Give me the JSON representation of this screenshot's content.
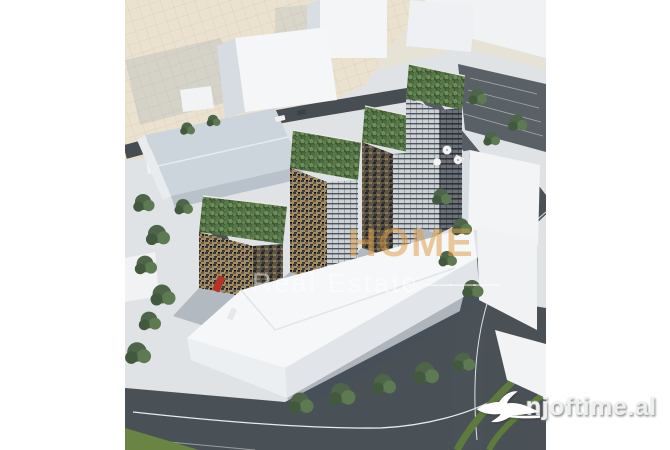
{
  "image": {
    "type": "aerial-architectural-render",
    "subject": "modern residential towers with green rooftops in a city block",
    "palette": {
      "plaza_beige": "#eae2cf",
      "ground_cool": "#e0e4e8",
      "road_dark": "#4a5156",
      "massing_white": "#f4f5f7",
      "facade_tan": "#a38b63",
      "facade_dark": "#32373c",
      "roof_green": "#3c5538",
      "tree_green": "#4e6549",
      "vehicle_red": "#b33527"
    }
  },
  "watermark": {
    "brand_visible": "HOME",
    "tagline": "Real Estate",
    "dash": "———",
    "brand_color": "#dfa04a",
    "tagline_color": "#ffffff"
  },
  "logo": {
    "text": "njoftime.al",
    "icon": "swallow-bird",
    "text_color": "#efefef"
  }
}
